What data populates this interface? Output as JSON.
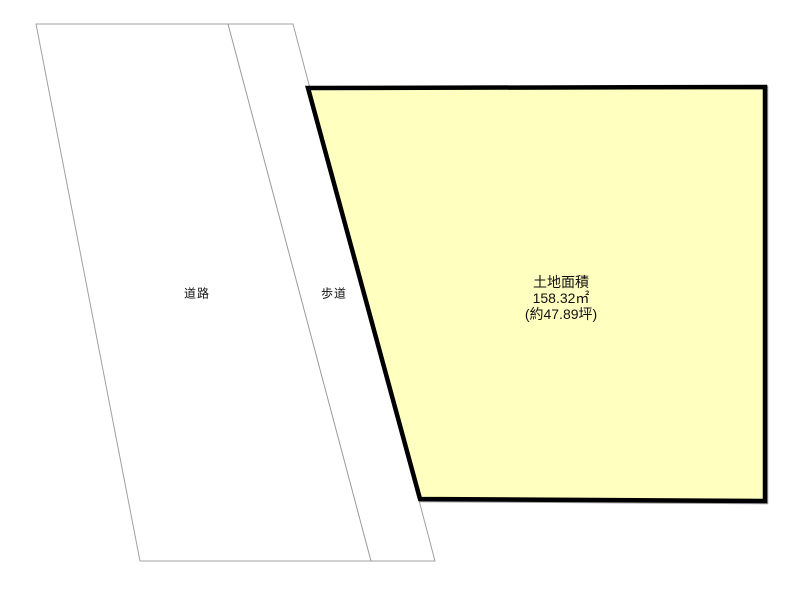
{
  "diagram": {
    "background_color": "#ffffff",
    "road": {
      "label": "道路",
      "points": "36,24 293,24 435,561 140,561",
      "fill": "#ffffff",
      "outline_color": "#a0a0a0"
    },
    "sidewalk": {
      "label": "歩道",
      "divider_points": "228,24 371,561",
      "divider_color": "#9a9a9a"
    },
    "land": {
      "points": "308,88 765,87 765,501 420,499",
      "fill": "#ffffc0",
      "border_color": "#000000",
      "area_title": "土地面積",
      "area_square_meters": "158.32㎡",
      "area_tsubo": "(約47.89坪)"
    }
  }
}
